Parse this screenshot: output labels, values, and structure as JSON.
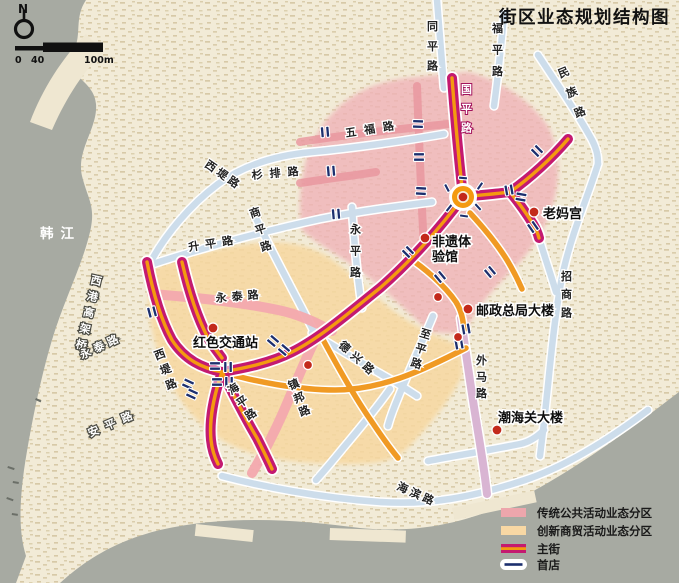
{
  "title": "街区业态规划结构图",
  "north_label": "N",
  "scale": {
    "tick0": "0",
    "tick40": "40",
    "tick100": "100m"
  },
  "water": {
    "river_name": "韩江"
  },
  "roads": {
    "labels": [
      {
        "text": "同平路"
      },
      {
        "text": "福平路"
      },
      {
        "text": "民族路"
      },
      {
        "text": "国平路"
      },
      {
        "text": "五福路"
      },
      {
        "text": "西堤路"
      },
      {
        "text": "杉排路"
      },
      {
        "text": "升平路"
      },
      {
        "text": "商平路"
      },
      {
        "text": "永平路"
      },
      {
        "text": "永泰路"
      },
      {
        "text": "西港高架桥"
      },
      {
        "text": "永泰路"
      },
      {
        "text": "安平路"
      },
      {
        "text": "西堤路"
      },
      {
        "text": "海平路"
      },
      {
        "text": "镇邦路"
      },
      {
        "text": "德兴路"
      },
      {
        "text": "至平路"
      },
      {
        "text": "外马路"
      },
      {
        "text": "招商路"
      },
      {
        "text": "海滨路"
      }
    ]
  },
  "pois": [
    {
      "name": "老妈宫"
    },
    {
      "name": "非遗体验馆",
      "line1": "非遗体",
      "line2": "验馆"
    },
    {
      "name": "邮政总局大楼"
    },
    {
      "name": "红色交通站"
    },
    {
      "name": "潮海关大楼"
    }
  ],
  "legend": {
    "items": [
      {
        "label": "传统公共活动业态分区",
        "type": "zone",
        "color": "#f0b3b8"
      },
      {
        "label": "创新商贸活动业态分区",
        "type": "zone",
        "color": "#f7d8a0"
      },
      {
        "label": "主街",
        "type": "main-street",
        "color": "#c41a70"
      },
      {
        "label": "首店",
        "type": "first-store",
        "color": "#1c2f6e"
      }
    ]
  },
  "colors": {
    "water": "#a7aaa2",
    "land": "#f2ebd7",
    "pink_zone": "#f0b3b8",
    "orange_zone": "#f7d8a0",
    "main_street_magenta": "#c41a70",
    "main_street_core_orange": "#f49a10",
    "secondary_road_blue": "#cdddeb",
    "waima_road_mauve": "#d9b5d3",
    "pink_road": "#f3a9ae",
    "first_store_navy": "#1c2f6e",
    "poi_dot_red": "#c3291b"
  }
}
